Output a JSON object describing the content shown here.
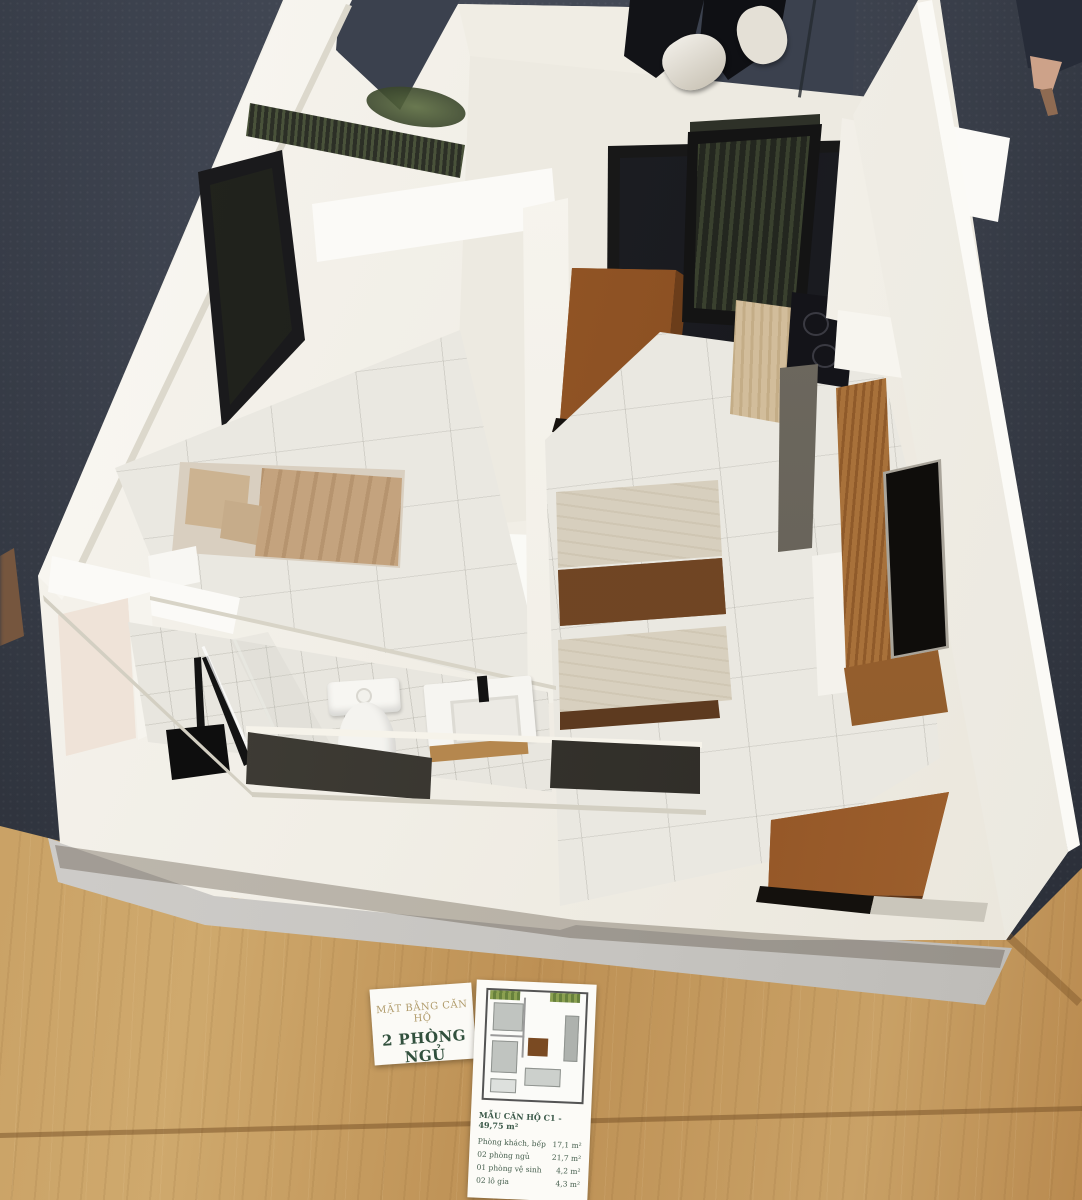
{
  "scene": {
    "setting": "Photograph of an architectural scale model of a two-bedroom apartment, displayed on a wooden table over dark carpet with visitors standing behind",
    "colors": {
      "carpet": "#3d4350",
      "table_wood": "#c49b60",
      "model_white": "#f2efe7",
      "door_wood": "#9a5a28",
      "dining_table_wood": "#6e4423",
      "fabric_beige": "#d7cfbe",
      "bed_tan": "#c4a37e",
      "fixture_black": "#161616",
      "accent_gold": "#b19c6c",
      "accent_green": "#31503d"
    }
  },
  "label_card": {
    "line1": "MẶT BẰNG CĂN HỘ",
    "line2": "2 PHÒNG NGỦ"
  },
  "spec_sheet": {
    "header": "MẪU CĂN HỘ C1 - 49,75 m²",
    "rows": [
      {
        "label": "Phòng khách, bếp",
        "value": "17,1 m²"
      },
      {
        "label": "02 phòng ngủ",
        "value": "21,7 m²"
      },
      {
        "label": "01 phòng vệ sinh",
        "value": "4,2 m²"
      },
      {
        "label": "02 lô gia",
        "value": "4,3 m²"
      }
    ]
  }
}
